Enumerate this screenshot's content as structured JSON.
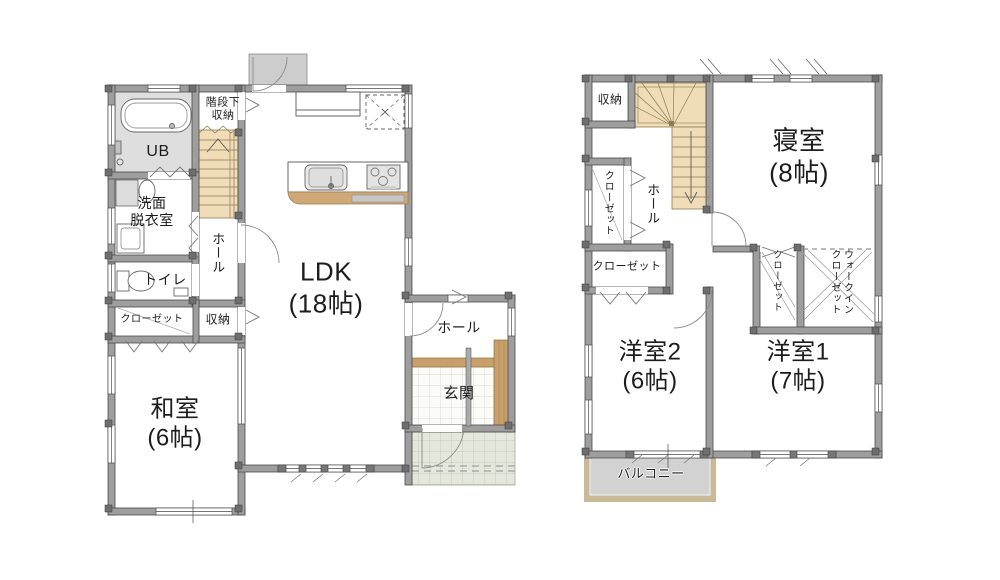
{
  "palette": {
    "wall": "#9e9e9e",
    "wall_edge": "#4a4a4a",
    "pillar": "#6e6e6e",
    "stairs": "#f0ddb8",
    "stairs_line": "#8d7b52",
    "wood": "#c9a06b",
    "bath_floor": "#dedede",
    "tile": "#fbfbf8",
    "porch": "#e4e7db",
    "balcony_fill": "#d2d2d2",
    "balcony_edge": "#c8ba99",
    "door_arc": "#8a8a8a",
    "text": "#1c1c1c"
  },
  "floor1": {
    "labels": {
      "stair_storage": "階段下\n収納",
      "ub": "UB",
      "washroom": "洗面\n脱衣室",
      "toilet": "トイレ",
      "hall": "ホール",
      "closet": "クローゼット",
      "storage": "収納",
      "japanese_room": "和室\n(6帖)",
      "ldk": "LDK\n(18帖)",
      "entrance_hall": "ホール",
      "entrance": "玄関"
    }
  },
  "floor2": {
    "labels": {
      "storage": "収納",
      "closet_left": "クローゼット",
      "hall": "ホール",
      "bedroom": "寝室\n(8帖)",
      "closet_mid": "クローゼット",
      "closet_small": "クローゼット",
      "walk_in_closet": "ウォークイン\nクローゼット",
      "western_room2": "洋室2\n(6帖)",
      "western_room1": "洋室1\n(7帖)",
      "balcony": "バルコニー"
    }
  }
}
